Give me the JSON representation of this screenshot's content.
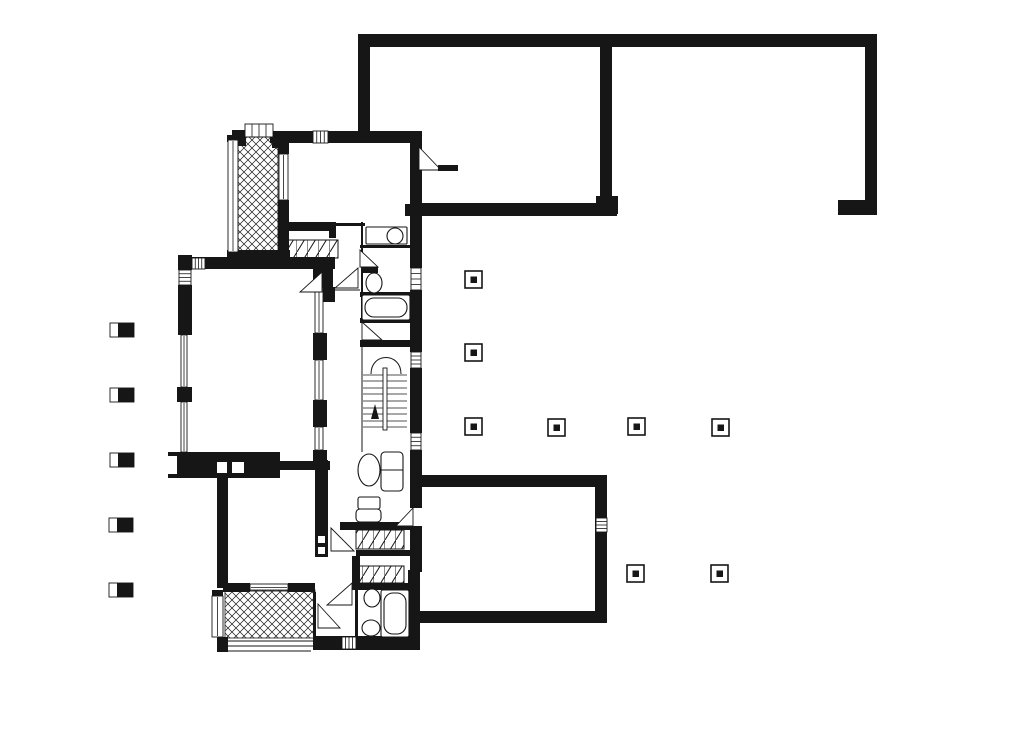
{
  "meta": {
    "title": "Architectural floor plan drawing",
    "canvas": {
      "w": 1024,
      "h": 750
    }
  },
  "colors": {
    "ink": "#161616",
    "paper": "#ffffff"
  },
  "plan": {
    "walls": [
      [
        358,
        34,
        519,
        13
      ],
      [
        358,
        34,
        12,
        108
      ],
      [
        600,
        34,
        12,
        170
      ],
      [
        596,
        196,
        22,
        18
      ],
      [
        865,
        34,
        12,
        172
      ],
      [
        838,
        200,
        39,
        15
      ],
      [
        410,
        203,
        207,
        13
      ],
      [
        270,
        131,
        152,
        12
      ],
      [
        232,
        130,
        14,
        16
      ],
      [
        272,
        131,
        17,
        17
      ],
      [
        227,
        135,
        12,
        7
      ],
      [
        227,
        250,
        63,
        12
      ],
      [
        278,
        132,
        11,
        22
      ],
      [
        278,
        200,
        11,
        52
      ],
      [
        288,
        222,
        48,
        9
      ],
      [
        329,
        222,
        7,
        16
      ],
      [
        335,
        223,
        30,
        3
      ],
      [
        410,
        143,
        12,
        62
      ],
      [
        405,
        204,
        30,
        12
      ],
      [
        410,
        216,
        12,
        52
      ],
      [
        410,
        290,
        12,
        62
      ],
      [
        410,
        368,
        12,
        65
      ],
      [
        410,
        450,
        12,
        58
      ],
      [
        410,
        526,
        12,
        46
      ],
      [
        408,
        570,
        12,
        80
      ],
      [
        361,
        222,
        2,
        98
      ],
      [
        360,
        245,
        50,
        3
      ],
      [
        360,
        292,
        50,
        5
      ],
      [
        360,
        318,
        50,
        5
      ],
      [
        360,
        340,
        50,
        7
      ],
      [
        178,
        255,
        14,
        15
      ],
      [
        178,
        257,
        157,
        12
      ],
      [
        178,
        285,
        14,
        50
      ],
      [
        177,
        387,
        15,
        15
      ],
      [
        168,
        452,
        112,
        26
      ],
      [
        280,
        461,
        50,
        9
      ],
      [
        313,
        257,
        14,
        30
      ],
      [
        313,
        333,
        14,
        27
      ],
      [
        313,
        400,
        14,
        27
      ],
      [
        313,
        450,
        14,
        20
      ],
      [
        320,
        258,
        13,
        29
      ],
      [
        320,
        287,
        15,
        15
      ],
      [
        217,
        478,
        11,
        110
      ],
      [
        212,
        590,
        11,
        6
      ],
      [
        217,
        637,
        11,
        15
      ],
      [
        315,
        460,
        13,
        68
      ],
      [
        315,
        528,
        13,
        29
      ],
      [
        223,
        583,
        27,
        9
      ],
      [
        288,
        583,
        27,
        9
      ],
      [
        340,
        522,
        80,
        8
      ],
      [
        356,
        550,
        64,
        6
      ],
      [
        352,
        556,
        8,
        27
      ],
      [
        352,
        583,
        68,
        7
      ],
      [
        313,
        592,
        3,
        44
      ],
      [
        355,
        590,
        3,
        46
      ],
      [
        313,
        636,
        107,
        14
      ],
      [
        413,
        475,
        194,
        12
      ],
      [
        595,
        475,
        12,
        148
      ],
      [
        413,
        611,
        194,
        12
      ]
    ],
    "white_insets": [
      [
        168,
        456,
        9,
        18
      ],
      [
        217,
        462,
        10,
        11
      ],
      [
        232,
        462,
        12,
        11
      ],
      [
        318,
        536,
        7,
        7
      ],
      [
        318,
        547,
        7,
        7
      ],
      [
        410,
        508,
        12,
        18
      ]
    ],
    "windows": [
      {
        "r": [
          245,
          124,
          28,
          13
        ],
        "s": "rungs"
      },
      {
        "r": [
          228,
          140,
          10,
          112
        ],
        "s": "rail"
      },
      {
        "r": [
          279,
          154,
          9,
          46
        ],
        "s": "rail"
      },
      {
        "r": [
          313,
          131,
          15,
          12
        ],
        "s": "rungs"
      },
      {
        "r": [
          192,
          258,
          13,
          11
        ],
        "s": "rungs"
      },
      {
        "r": [
          179,
          270,
          12,
          15
        ],
        "s": "rungs"
      },
      {
        "r": [
          181,
          335,
          6,
          52
        ],
        "s": "rail"
      },
      {
        "r": [
          181,
          402,
          6,
          50
        ],
        "s": "rail"
      },
      {
        "r": [
          315,
          287,
          8,
          46
        ],
        "s": "rail"
      },
      {
        "r": [
          315,
          360,
          8,
          40
        ],
        "s": "rail"
      },
      {
        "r": [
          315,
          427,
          8,
          23
        ],
        "s": "rail"
      },
      {
        "r": [
          411,
          268,
          10,
          22
        ],
        "s": "rungs"
      },
      {
        "r": [
          411,
          352,
          10,
          16
        ],
        "s": "rungs"
      },
      {
        "r": [
          411,
          433,
          10,
          17
        ],
        "s": "rungs"
      },
      {
        "r": [
          596,
          518,
          11,
          14
        ],
        "s": "rungs"
      },
      {
        "r": [
          250,
          584,
          38,
          7
        ],
        "s": "rail"
      },
      {
        "r": [
          212,
          596,
          11,
          41
        ],
        "s": "rail"
      },
      {
        "r": [
          342,
          637,
          14,
          12
        ],
        "s": "rungs"
      }
    ],
    "crosshatch_areas": [
      [
        238,
        137,
        40,
        115
      ],
      [
        225,
        590,
        90,
        48
      ]
    ],
    "closet_hatch_areas": [
      [
        288,
        240,
        50,
        18
      ],
      [
        356,
        530,
        48,
        19
      ],
      [
        356,
        566,
        48,
        17
      ]
    ],
    "columns": [
      [
        465,
        271
      ],
      [
        465,
        344
      ],
      [
        465,
        418
      ],
      [
        548,
        419
      ],
      [
        628,
        418
      ],
      [
        712,
        419
      ],
      [
        627,
        565
      ],
      [
        711,
        565
      ]
    ],
    "posts": [
      [
        110,
        323
      ],
      [
        110,
        388
      ],
      [
        110,
        453
      ],
      [
        109,
        518
      ],
      [
        109,
        583
      ]
    ],
    "door_swings": [
      {
        "pts": [
          [
            360,
            250
          ],
          [
            378,
            267
          ],
          [
            360,
            267
          ]
        ]
      },
      {
        "pts": [
          [
            300,
            292
          ],
          [
            322,
            292
          ],
          [
            322,
            272
          ]
        ]
      },
      {
        "pts": [
          [
            335,
            288
          ],
          [
            358,
            288
          ],
          [
            358,
            268
          ]
        ]
      },
      {
        "pts": [
          [
            419,
            147
          ],
          [
            419,
            170
          ],
          [
            441,
            170
          ]
        ]
      },
      {
        "pts": [
          [
            362,
            322
          ],
          [
            362,
            340
          ],
          [
            382,
            340
          ]
        ]
      },
      {
        "pts": [
          [
            396,
            526
          ],
          [
            413,
            526
          ],
          [
            413,
            508
          ]
        ]
      },
      {
        "pts": [
          [
            331,
            528
          ],
          [
            331,
            551
          ],
          [
            354,
            551
          ]
        ]
      },
      {
        "pts": [
          [
            352,
            583
          ],
          [
            352,
            605
          ],
          [
            327,
            605
          ]
        ]
      },
      {
        "pts": [
          [
            318,
            604
          ],
          [
            318,
            628
          ],
          [
            340,
            628
          ]
        ]
      }
    ],
    "door_leaves": [
      [
        362,
        267,
        16,
        6
      ],
      [
        438,
        165,
        20,
        6
      ]
    ],
    "door_lines": [
      [
        333,
        290,
        360,
        290
      ]
    ],
    "stair": {
      "curve": "M371 374 C371 352 401 352 401 374",
      "treads_y": [
        375,
        381,
        388,
        394,
        401,
        408,
        414,
        421,
        427
      ],
      "tread_x1": 363,
      "tread_x2": 407,
      "stringer": [
        383,
        368,
        4,
        62
      ],
      "arrow": [
        [
          371,
          419
        ],
        [
          379,
          419
        ],
        [
          375,
          404
        ]
      ],
      "side_line": [
        362,
        347,
        362,
        452
      ]
    },
    "fixtures": {
      "ellipses": [
        {
          "cx": 395,
          "cy": 236,
          "rx": 8,
          "ry": 8,
          "name": "toilet-bowl"
        },
        {
          "cx": 374,
          "cy": 283,
          "rx": 8,
          "ry": 10,
          "name": "sink"
        },
        {
          "cx": 369,
          "cy": 470,
          "rx": 11,
          "ry": 16,
          "name": "armchair"
        },
        {
          "cx": 372,
          "cy": 598,
          "rx": 8,
          "ry": 9,
          "name": "toilet-bowl"
        },
        {
          "cx": 371,
          "cy": 628,
          "rx": 9,
          "ry": 8,
          "name": "sink"
        }
      ],
      "rects": [
        {
          "r": [
            366,
            227,
            41,
            17
          ],
          "rx": 1,
          "name": "wc-cistern"
        },
        {
          "r": [
            362,
            295,
            48,
            25
          ],
          "rx": 2,
          "name": "bathtub-frame"
        },
        {
          "r": [
            365,
            298,
            42,
            19
          ],
          "rx": 9,
          "name": "bathtub"
        },
        {
          "r": [
            381,
            452,
            22,
            39
          ],
          "rx": 4,
          "name": "sofa"
        },
        {
          "r": [
            358,
            497,
            22,
            12
          ],
          "rx": 2,
          "name": "chair-back"
        },
        {
          "r": [
            356,
            509,
            25,
            13
          ],
          "rx": 4,
          "name": "chair-seat"
        },
        {
          "r": [
            381,
            590,
            28,
            47
          ],
          "rx": 2,
          "name": "bathtub-frame"
        },
        {
          "r": [
            384,
            593,
            22,
            41
          ],
          "rx": 9,
          "name": "bathtub"
        }
      ],
      "lines": [
        [
          381,
          470,
          403,
          470
        ]
      ]
    },
    "step_lines": [
      [
        225,
        641,
        313,
        641
      ],
      [
        225,
        646,
        313,
        646
      ],
      [
        227,
        651,
        311,
        651
      ]
    ]
  }
}
